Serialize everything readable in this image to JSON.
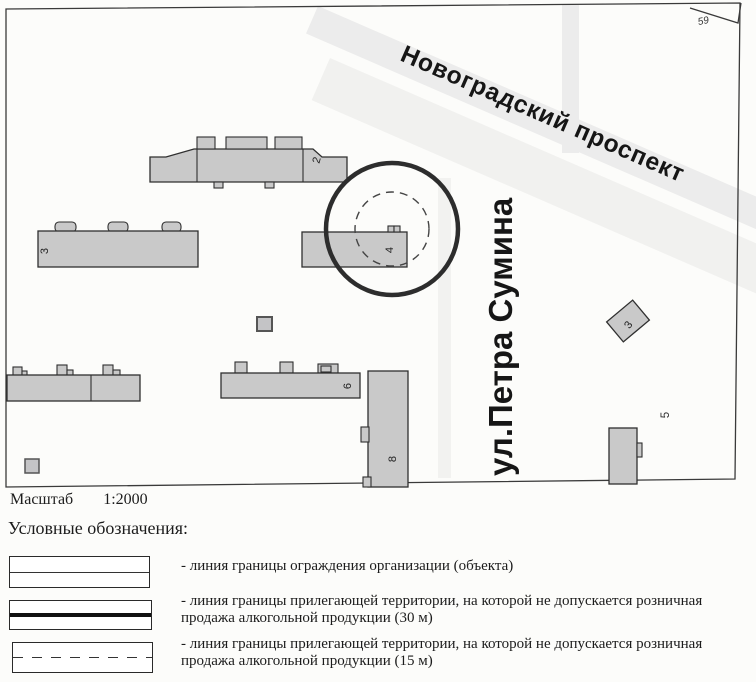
{
  "map": {
    "streets": {
      "avenue": "Новоградский проспект",
      "street": "ул.Петра Сумина"
    },
    "labels": {
      "parcel_59": "59",
      "parcel_5": "5"
    },
    "buildings": {
      "b2": "2",
      "b3_left": "3",
      "b4": "4",
      "b6": "6",
      "b8": "8",
      "b3_right": "3"
    }
  },
  "scale": {
    "label": "Масштаб",
    "value": "1:2000"
  },
  "legend": {
    "title": "Условные обозначения:",
    "items": [
      {
        "style": "thin-solid",
        "text": "- линия границы ограждения организации (объекта)"
      },
      {
        "style": "thick-solid",
        "text": "- линия границы прилегающей территории, на которой не допускается розничная продажа алкогольной продукции (30 м)"
      },
      {
        "style": "dashed",
        "text": "- линия границы прилегающей территории, на которой не допускается розничная продажа алкогольной продукции (15 м)"
      }
    ]
  },
  "colors": {
    "building_fill": "#c9c9c9",
    "building_outline": "#2f2f2f",
    "frame_line": "#3a3a3a",
    "circle_stroke": "#2d2d2d",
    "road_band": "#e9e9e9",
    "text_dark": "#161616"
  }
}
